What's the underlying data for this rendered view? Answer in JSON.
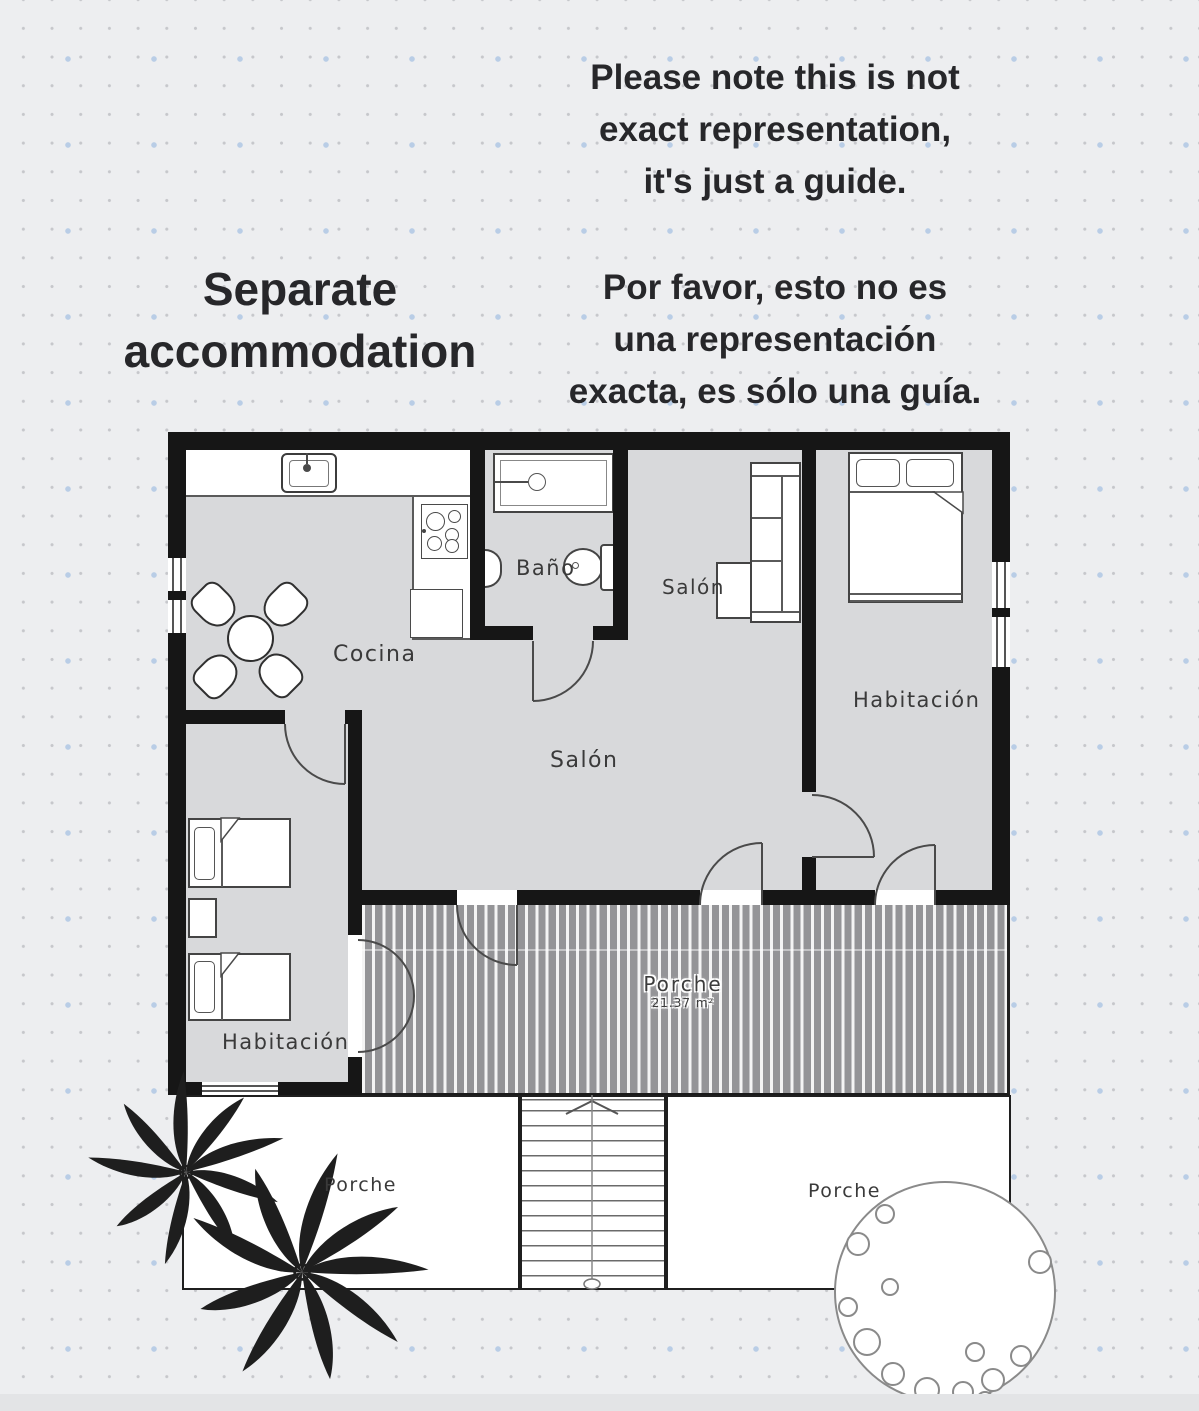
{
  "header": {
    "title": "Separate accommodation",
    "note_en": [
      "Please note this is not",
      "exact representation,",
      "it's just a guide."
    ],
    "note_es": [
      "Por favor, esto no es",
      "una representación",
      "exacta, es sólo una guía."
    ]
  },
  "floorplan": {
    "labels": {
      "kitchen": "Cocina",
      "bathroom": "Baño",
      "living_top": "Salón",
      "living_main": "Salón",
      "bedroom_right": "Habitación",
      "bedroom_left": "Habitación",
      "deck": "Porche",
      "deck_area": "21.37 m²",
      "porch_left": "Porche",
      "porch_right": "Porche"
    }
  },
  "colors": {
    "background": "#edeef0",
    "wall": "#161616",
    "floor": "#d8d9db",
    "deck_gray": "#949497",
    "dot_accent_blue": "#b9cde6",
    "heading_text": "#27272a",
    "label_text": "#3a3a3a"
  }
}
